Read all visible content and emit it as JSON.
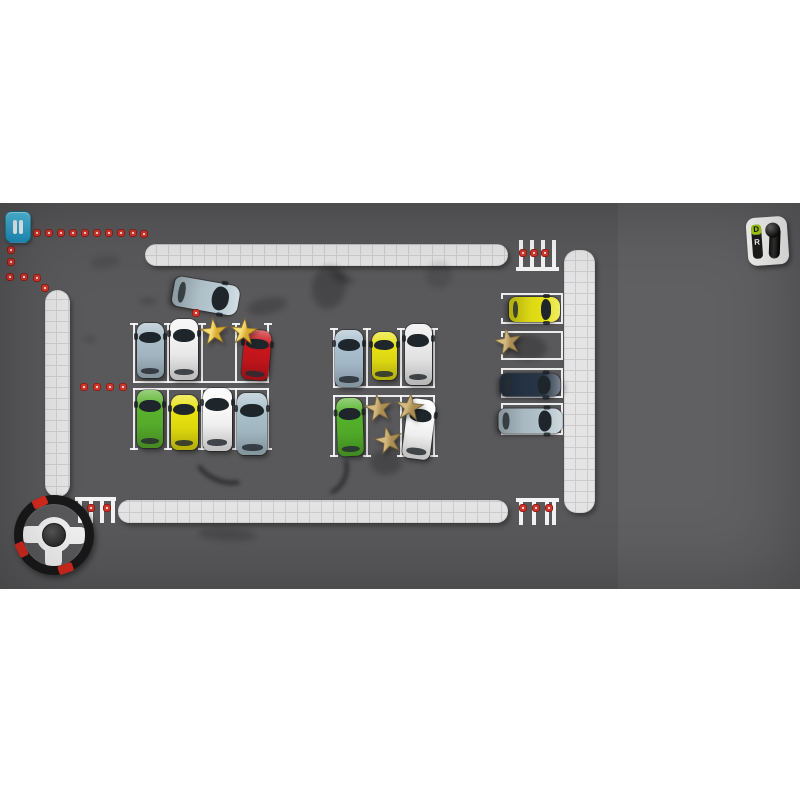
{
  "hud": {
    "pause": {
      "icon": "pause-icon"
    },
    "shifter": {
      "drive_label": "D",
      "reverse_label": "R"
    },
    "wheel": {
      "red_segment_angles": [
        336,
        245,
        160
      ],
      "spoke_angles": [
        90,
        270,
        180
      ]
    }
  },
  "palette": {
    "page_bg": "#ffffff",
    "asphalt": "#59595b",
    "curb": "#e4e4e4",
    "curb_line": "#cccccc",
    "spot_line": "#f8f8f8",
    "path_dot_red": "#cf372d",
    "pause_blue": "#2fa9d2",
    "gear_green": "#a8cf12",
    "star_gold": "#e4c044",
    "star_tan": "#c2a263",
    "wheel_red": "#d42a1f"
  },
  "scene": {
    "curbs": [
      {
        "name": "top-curb",
        "dir": "h",
        "x": 145,
        "y": 41,
        "w": 363,
        "h": 22
      },
      {
        "name": "bottom-curb",
        "dir": "h",
        "x": 118,
        "y": 297,
        "w": 390,
        "h": 23
      },
      {
        "name": "left-curb",
        "dir": "v",
        "x": 45,
        "y": 87,
        "w": 25,
        "h": 207
      },
      {
        "name": "right-curb",
        "dir": "v",
        "x": 564,
        "y": 47,
        "w": 31,
        "h": 263
      }
    ],
    "crosswalks": [
      {
        "name": "top-crosswalk",
        "x": 516,
        "y": 37,
        "w": 43,
        "h": 31,
        "bar": "bottom",
        "stripe_x": [
          3,
          14,
          25,
          36
        ],
        "dots": [
          [
            7,
            13
          ],
          [
            18,
            13
          ],
          [
            29,
            13
          ]
        ]
      },
      {
        "name": "bottom-crosswalk",
        "x": 516,
        "y": 295,
        "w": 43,
        "h": 27,
        "bar": "top",
        "stripe_x": [
          3,
          16,
          29,
          36
        ],
        "dots": [
          [
            7,
            10
          ],
          [
            20,
            10
          ],
          [
            33,
            10
          ]
        ]
      },
      {
        "name": "bottom-left-crosswalk",
        "x": 75,
        "y": 294,
        "w": 41,
        "h": 26,
        "bar": "top",
        "stripe_x": [
          3,
          14,
          25,
          36
        ],
        "dots": [
          [
            16,
            11
          ],
          [
            32,
            11
          ]
        ]
      }
    ],
    "path_dots": [
      [
        37,
        30
      ],
      [
        49,
        30
      ],
      [
        61,
        30
      ],
      [
        73,
        30
      ],
      [
        85,
        30
      ],
      [
        97,
        30
      ],
      [
        109,
        30
      ],
      [
        121,
        30
      ],
      [
        133,
        30
      ],
      [
        144,
        31
      ],
      [
        11,
        47
      ],
      [
        11,
        59
      ],
      [
        10,
        74
      ],
      [
        24,
        74
      ],
      [
        37,
        75
      ],
      [
        45,
        85
      ],
      [
        196,
        110
      ],
      [
        84,
        184
      ],
      [
        97,
        184
      ],
      [
        110,
        184
      ],
      [
        123,
        184
      ]
    ],
    "spot_rows": [
      {
        "name": "left-block-top-row",
        "x": 133,
        "y": 120,
        "h": 60,
        "dividers": [
          0,
          34,
          68,
          102,
          134
        ],
        "open": "top"
      },
      {
        "name": "left-block-bottom-row",
        "x": 133,
        "y": 185,
        "h": 62,
        "dividers": [
          0,
          34,
          68,
          102,
          134
        ],
        "open": "bottom"
      },
      {
        "name": "middle-block-top-row",
        "x": 333,
        "y": 125,
        "h": 60,
        "dividers": [
          0,
          33,
          67,
          100
        ],
        "open": "top"
      },
      {
        "name": "middle-block-bottom-row",
        "x": 333,
        "y": 192,
        "h": 62,
        "dividers": [
          0,
          33,
          67,
          100
        ],
        "open": "bottom"
      }
    ],
    "side_spots": [
      {
        "name": "right-spot-1",
        "x": 503,
        "y": 90,
        "w": 60,
        "h": 31
      },
      {
        "name": "right-spot-2",
        "x": 503,
        "y": 128,
        "w": 60,
        "h": 29
      },
      {
        "name": "right-spot-3",
        "x": 503,
        "y": 165,
        "w": 60,
        "h": 30
      },
      {
        "name": "right-spot-4",
        "x": 503,
        "y": 200,
        "w": 60,
        "h": 32
      }
    ],
    "cars": [
      {
        "name": "player-car",
        "cx": 206,
        "cy": 93,
        "w": 30,
        "l": 66,
        "rot": 100,
        "color": "#b7c9d2",
        "player": true
      },
      {
        "name": "parked-car-silver",
        "cx": 150,
        "cy": 147,
        "w": 27,
        "l": 55,
        "rot": 0,
        "color": "#a9bdc9"
      },
      {
        "name": "parked-car-white",
        "cx": 184,
        "cy": 146,
        "w": 28,
        "l": 61,
        "rot": 0,
        "color": "#f3f3f3"
      },
      {
        "name": "parked-car-red",
        "cx": 256,
        "cy": 152,
        "w": 27,
        "l": 50,
        "rot": 5,
        "color": "#c9161c"
      },
      {
        "name": "parked-car-green",
        "cx": 150,
        "cy": 216,
        "w": 26,
        "l": 58,
        "rot": 0,
        "color": "#5ab32d"
      },
      {
        "name": "parked-car-yellow",
        "cx": 184,
        "cy": 219,
        "w": 27,
        "l": 55,
        "rot": 0,
        "color": "#e9e20e"
      },
      {
        "name": "parked-van-white",
        "cx": 217,
        "cy": 216,
        "w": 29,
        "l": 63,
        "rot": 0,
        "color": "#fafafa"
      },
      {
        "name": "parked-car-slate",
        "cx": 252,
        "cy": 221,
        "w": 30,
        "l": 62,
        "rot": 0,
        "color": "#a9c0cb"
      },
      {
        "name": "parked-suv-slate",
        "cx": 349,
        "cy": 155,
        "w": 28,
        "l": 57,
        "rot": 0,
        "color": "#a9bfcf"
      },
      {
        "name": "parked-car-yellow2",
        "cx": 384,
        "cy": 153,
        "w": 25,
        "l": 48,
        "rot": 0,
        "color": "#e7e112"
      },
      {
        "name": "parked-suv-white",
        "cx": 418,
        "cy": 151,
        "w": 27,
        "l": 61,
        "rot": 0,
        "color": "#ececec"
      },
      {
        "name": "parked-car-green2",
        "cx": 350,
        "cy": 224,
        "w": 26,
        "l": 58,
        "rot": -2,
        "color": "#54b22a"
      },
      {
        "name": "parked-car-white2",
        "cx": 419,
        "cy": 226,
        "w": 28,
        "l": 60,
        "rot": 7,
        "color": "#fbfbfb"
      },
      {
        "name": "parked-car-yellow3",
        "cx": 534,
        "cy": 106,
        "w": 25,
        "l": 51,
        "rot": 90,
        "color": "#e6e214"
      },
      {
        "name": "parked-suv-navy",
        "cx": 530,
        "cy": 182,
        "w": 23,
        "l": 60,
        "rot": 90,
        "color": "#273546"
      },
      {
        "name": "parked-car-silver2",
        "cx": 530,
        "cy": 218,
        "w": 25,
        "l": 64,
        "rot": 90,
        "color": "#b2c3cc"
      }
    ],
    "stars": [
      {
        "name": "star",
        "cx": 214,
        "cy": 129,
        "s": 30,
        "tone": "gold",
        "rot": -6
      },
      {
        "name": "star",
        "cx": 244,
        "cy": 129,
        "s": 30,
        "tone": "gold",
        "rot": 4
      },
      {
        "name": "star",
        "cx": 378,
        "cy": 205,
        "s": 31,
        "tone": "tan",
        "rot": -8
      },
      {
        "name": "star",
        "cx": 409,
        "cy": 204,
        "s": 31,
        "tone": "tan",
        "rot": 6
      },
      {
        "name": "star",
        "cx": 388,
        "cy": 237,
        "s": 31,
        "tone": "tan",
        "rot": -12
      },
      {
        "name": "star",
        "cx": 508,
        "cy": 139,
        "s": 30,
        "tone": "tan",
        "rot": -10
      }
    ],
    "skid_marks": [
      {
        "x": 247,
        "y": 95,
        "w": 40,
        "h": 16,
        "rot": -12,
        "op": 0.18,
        "arc": false
      },
      {
        "x": 312,
        "y": 62,
        "w": 34,
        "h": 44,
        "rot": 10,
        "op": 0.2,
        "arc": false
      },
      {
        "x": 330,
        "y": 70,
        "w": 24,
        "h": 9,
        "rot": 25,
        "op": 0.22,
        "arc": false
      },
      {
        "x": 426,
        "y": 58,
        "w": 26,
        "h": 28,
        "rot": 15,
        "op": 0.1,
        "arc": false
      },
      {
        "x": 140,
        "y": 95,
        "w": 16,
        "h": 6,
        "rot": 0,
        "op": 0.18,
        "arc": false
      },
      {
        "x": 84,
        "y": 133,
        "w": 11,
        "h": 6,
        "rot": 0,
        "op": 0.15,
        "arc": false
      },
      {
        "x": 193,
        "y": 242,
        "w": 52,
        "h": 30,
        "rot": 22,
        "op": 0.55,
        "arc": true
      },
      {
        "x": 300,
        "y": 246,
        "w": 44,
        "h": 36,
        "rot": -65,
        "op": 0.5,
        "arc": true
      },
      {
        "x": 370,
        "y": 246,
        "w": 32,
        "h": 26,
        "rot": 0,
        "op": 0.2,
        "arc": false
      },
      {
        "x": 198,
        "y": 325,
        "w": 58,
        "h": 13,
        "rot": 3,
        "op": 0.16,
        "arc": false
      },
      {
        "x": 505,
        "y": 131,
        "w": 42,
        "h": 26,
        "rot": 8,
        "op": 0.22,
        "arc": false
      },
      {
        "x": 528,
        "y": 174,
        "w": 38,
        "h": 22,
        "rot": 0,
        "op": 0.25,
        "arc": false
      },
      {
        "x": 90,
        "y": 52,
        "w": 30,
        "h": 14,
        "rot": -8,
        "op": 0.1,
        "arc": false
      }
    ]
  }
}
